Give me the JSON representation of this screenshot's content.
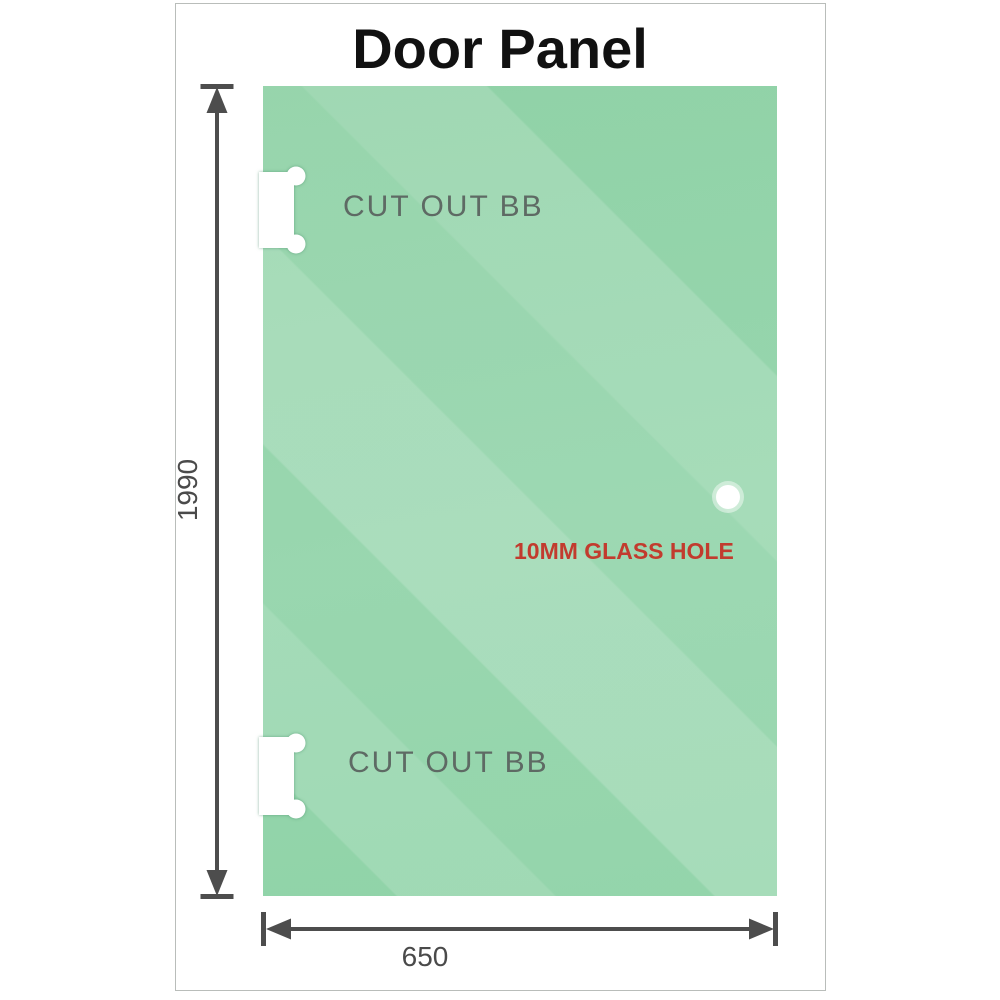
{
  "title": "Door Panel",
  "panel": {
    "cutouts": [
      {
        "label": "CUT OUT BB"
      },
      {
        "label": "CUT OUT BB"
      }
    ],
    "hole": {
      "label": "10MM GLASS HOLE"
    },
    "dimensions": {
      "height": {
        "value": "1990"
      },
      "width": {
        "value": "650"
      }
    }
  },
  "colors": {
    "glass_base": "#93d4aa",
    "glass_highlight": "#b2e3c4",
    "dimension_lines": "#4d4d4d",
    "cutout_label": "#5e6a64",
    "hole_label": "#c23b2e",
    "frame_border": "#b9bdba",
    "title_text": "#111111"
  }
}
